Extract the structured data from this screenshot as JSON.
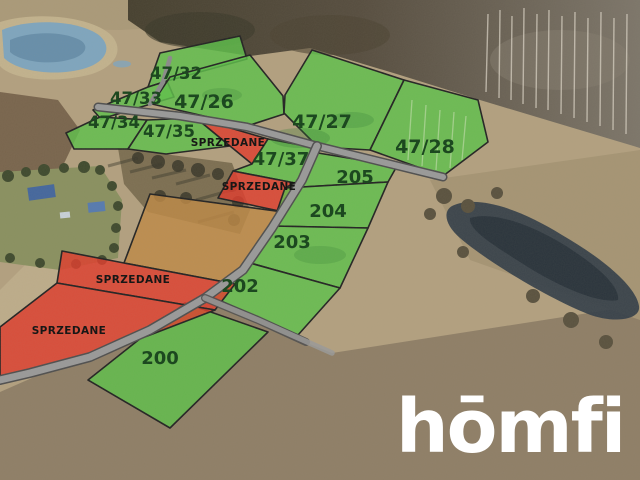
{
  "scene": {
    "type": "aerial-plot-offer-photo",
    "logo": {
      "text": "hōmfi"
    },
    "sold_label": "SPRZEDANE",
    "plots": [
      {
        "id": "47/32",
        "label": "47/32",
        "status": "available"
      },
      {
        "id": "47/33",
        "label": "47/33",
        "status": "available"
      },
      {
        "id": "47/34",
        "label": "47/34",
        "status": "available"
      },
      {
        "id": "47/35",
        "label": "47/35",
        "status": "available"
      },
      {
        "id": "47/26",
        "label": "47/26",
        "status": "available"
      },
      {
        "id": "47/27",
        "label": "47/27",
        "status": "available"
      },
      {
        "id": "47/28",
        "label": "47/28",
        "status": "available"
      },
      {
        "id": "sold-top",
        "label": "SPRZEDANE",
        "status": "sold"
      },
      {
        "id": "47/37",
        "label": "47/37",
        "status": "available"
      },
      {
        "id": "sold-mid",
        "label": "SPRZEDANE",
        "status": "sold"
      },
      {
        "id": "205",
        "label": "205",
        "status": "available"
      },
      {
        "id": "204",
        "label": "204",
        "status": "available"
      },
      {
        "id": "203",
        "label": "203",
        "status": "available"
      },
      {
        "id": "202",
        "label": "202",
        "status": "available"
      },
      {
        "id": "200",
        "label": "200",
        "status": "available"
      },
      {
        "id": "sold-left",
        "label": "SPRZEDANE",
        "status": "sold"
      },
      {
        "id": "sold-bottom",
        "label": "SPRZEDANE",
        "status": "sold"
      }
    ],
    "colors": {
      "available_fill": "#5ec24b",
      "sold_fill": "#e23c2c",
      "field_fill": "#bf8a45",
      "road": "#9a9a9a",
      "plot_number_text": "#15441a",
      "sold_text": "#101010",
      "logo_text_color": "#ffffff"
    }
  }
}
